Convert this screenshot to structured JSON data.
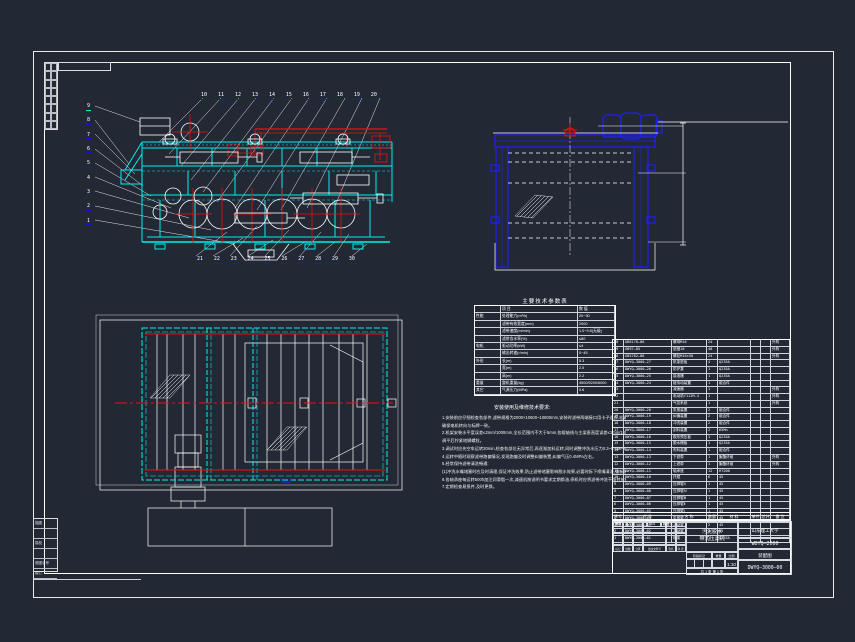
{
  "colors": {
    "background": "#222834",
    "cyan": "#00f0f0",
    "red": "#ee1111",
    "blue": "#2020ee",
    "white": "#ffffff",
    "callout_underline": "#1414e6"
  },
  "callouts": {
    "left": [
      "9",
      "8",
      "7",
      "6",
      "5",
      "4",
      "3",
      "2",
      "1"
    ],
    "top": [
      "10",
      "11",
      "12",
      "13",
      "14",
      "15",
      "16",
      "17",
      "18",
      "19",
      "20"
    ],
    "bottom": [
      "21",
      "22",
      "23",
      "24",
      "25",
      "26",
      "27",
      "28",
      "29",
      "30"
    ]
  },
  "params": {
    "title": "主要技术参数表",
    "rows": [
      {
        "g": "",
        "n": "项  目",
        "v": "数  值"
      },
      {
        "g": "性能",
        "n": "处理能力(m³/h)",
        "v": "20~30"
      },
      {
        "g": "",
        "n": "滤带有效宽度(mm)",
        "v": "2000"
      },
      {
        "g": "",
        "n": "滤带速度(m/min)",
        "v": "1.0~9.8(无级)"
      },
      {
        "g": "",
        "n": "滤饼含水率(%)",
        "v": "≤80"
      },
      {
        "g": "电机",
        "n": "驱动功率(kW)",
        "v": "≤4"
      },
      {
        "g": "",
        "n": "输出转速(r/min)",
        "v": "0~45"
      },
      {
        "g": "外形",
        "n": "长(m)",
        "v": "5.3"
      },
      {
        "g": "",
        "n": "宽(m)",
        "v": "2.5"
      },
      {
        "g": "",
        "n": "高(m)",
        "v": "2.2"
      },
      {
        "g": "重量",
        "n": "整机重量(kg)",
        "v": "4500/5200/6000"
      },
      {
        "g": "其它",
        "n": "气源压力(MPa)",
        "v": "0.6"
      }
    ]
  },
  "notes": {
    "title": "安装使用及维修技术要求:",
    "lines": [
      "1.安装前应仔细检查各部件,滤带规格为2000×10600~10800mm,安装时滤带两端接口用卡子连接,松紧适度,380V/50Hz电源接线,",
      "   确保电机转向与标牌一致。",
      "2.机架安装水平度误差≤2mm/1000mm,全长范围内不大于5mm,各辊轴线与主梁垂直度误差≤1mm/1000mm,否则影响滤带运行。",
      "   调平后拧紧地脚螺栓。",
      "3.调试时应先空车运转30min,检查各部位无异常后,再逐渐加料运转,同时调整冲洗水压力0.3~0.5MPa,保证冲洗效果良好。",
      "4.运转中随时观察滤带跑偏情况,发现跑偏及时调整纠偏装置,纠偏气压0.4MPa左右。",
      "5.经常保持滤带清洗畅通:",
      "   (1)冲洗水嘴堵塞时应及时清理,保证冲洗效果,防止滤带堵塞影响脱水效果,必要时拆下喷嘴清洗,重新装好后方可使用。",
      "6.各轴承座每运转500h加注润滑脂一次,减速机按说明书要求定期换油,停机时应将滤带冲洗干净并放松张紧装置。",
      "7.定期检查易损件,及时更换。"
    ]
  },
  "bom": {
    "headers": [
      "序号",
      "代  号",
      "名  称",
      "数量",
      "材  料",
      "单件",
      "总计",
      "备 注"
    ],
    "rows": [
      {
        "no": "30",
        "code": "GB6170—86",
        "name": "螺母M16",
        "qty": "24",
        "mat": "",
        "w1": "",
        "w2": "",
        "rem": "外购"
      },
      {
        "no": "29",
        "code": "GB97—85",
        "name": "垫圈16",
        "qty": "48",
        "mat": "",
        "w1": "",
        "w2": "",
        "rem": "外购"
      },
      {
        "no": "28",
        "code": "GB5782—86",
        "name": "螺栓M16×50",
        "qty": "24",
        "mat": "",
        "w1": "",
        "w2": "",
        "rem": "外购"
      },
      {
        "no": "27",
        "code": "DWYQ—3000—27",
        "name": "机架垫板",
        "qty": "4",
        "mat": "Q235A",
        "w1": "",
        "w2": "",
        "rem": ""
      },
      {
        "no": "26",
        "code": "DWYQ—3000—26",
        "name": "防护罩",
        "qty": "1",
        "mat": "Q235A",
        "w1": "",
        "w2": "",
        "rem": ""
      },
      {
        "no": "25",
        "code": "DWYQ—3000—25",
        "name": "接液槽",
        "qty": "1",
        "mat": "Q235A",
        "w1": "",
        "w2": "",
        "rem": ""
      },
      {
        "no": "24",
        "code": "DWYQ—3000—24",
        "name": "链传动装置",
        "qty": "1",
        "mat": "组合件",
        "w1": "",
        "w2": "",
        "rem": ""
      },
      {
        "no": "23",
        "code": "",
        "name": "减速器",
        "qty": "1",
        "mat": "",
        "w1": "",
        "w2": "",
        "rem": "外购"
      },
      {
        "no": "22",
        "code": "",
        "name": "电动机Y112M-4",
        "qty": "1",
        "mat": "",
        "w1": "",
        "w2": "",
        "rem": "外购"
      },
      {
        "no": "21",
        "code": "",
        "name": "气控系统",
        "qty": "1",
        "mat": "",
        "w1": "",
        "w2": "",
        "rem": "外购"
      },
      {
        "no": "20",
        "code": "DWYQ—3000—20",
        "name": "张紧装置",
        "qty": "2",
        "mat": "组合件",
        "w1": "",
        "w2": "",
        "rem": ""
      },
      {
        "no": "19",
        "code": "DWYQ—3000—19",
        "name": "纠偏装置",
        "qty": "2",
        "mat": "组合件",
        "w1": "",
        "w2": "",
        "rem": ""
      },
      {
        "no": "18",
        "code": "DWYQ—3000—18",
        "name": "冲洗装置",
        "qty": "2",
        "mat": "组合件",
        "w1": "",
        "w2": "",
        "rem": ""
      },
      {
        "no": "17",
        "code": "DWYQ—3000—17",
        "name": "刮料装置",
        "qty": "2",
        "mat": "65Mn",
        "w1": "",
        "w2": "",
        "rem": ""
      },
      {
        "no": "16",
        "code": "DWYQ—3000—16",
        "name": "楔形预压板",
        "qty": "1",
        "mat": "Q235A",
        "w1": "",
        "w2": "",
        "rem": ""
      },
      {
        "no": "15",
        "code": "DWYQ—3000—15",
        "name": "脱水栅板",
        "qty": "1",
        "mat": "Q235A",
        "w1": "",
        "w2": "",
        "rem": ""
      },
      {
        "no": "14",
        "code": "DWYQ—3000—14",
        "name": "布料装置",
        "qty": "1",
        "mat": "组合件",
        "w1": "",
        "w2": "",
        "rem": ""
      },
      {
        "no": "13",
        "code": "DWYQ—3000—13",
        "name": "下滤带",
        "qty": "1",
        "mat": "聚酯纤维",
        "w1": "",
        "w2": "",
        "rem": "外购"
      },
      {
        "no": "12",
        "code": "DWYQ—3000—12",
        "name": "上滤带",
        "qty": "1",
        "mat": "聚酯纤维",
        "w1": "",
        "w2": "",
        "rem": "外购"
      },
      {
        "no": "11",
        "code": "DWYQ—3000—11",
        "name": "轴承座",
        "qty": "12",
        "mat": "HT200",
        "w1": "",
        "w2": "",
        "rem": ""
      },
      {
        "no": "10",
        "code": "DWYQ—3000—10",
        "name": "托辊",
        "qty": "6",
        "mat": "45",
        "w1": "",
        "w2": "",
        "rem": ""
      },
      {
        "no": "9",
        "code": "DWYQ—3000—09",
        "name": "压榨辊Ⅴ",
        "qty": "1",
        "mat": "45",
        "w1": "",
        "w2": "",
        "rem": ""
      },
      {
        "no": "8",
        "code": "DWYQ—3000—08",
        "name": "压榨辊Ⅳ",
        "qty": "1",
        "mat": "45",
        "w1": "",
        "w2": "",
        "rem": ""
      },
      {
        "no": "7",
        "code": "DWYQ—3000—07",
        "name": "压榨辊Ⅲ",
        "qty": "1",
        "mat": "45",
        "w1": "",
        "w2": "",
        "rem": ""
      },
      {
        "no": "6",
        "code": "DWYQ—3000—06",
        "name": "压榨辊Ⅱ",
        "qty": "1",
        "mat": "45",
        "w1": "",
        "w2": "",
        "rem": ""
      },
      {
        "no": "5",
        "code": "DWYQ—3000—05",
        "name": "压榨辊Ⅰ",
        "qty": "1",
        "mat": "45",
        "w1": "",
        "w2": "",
        "rem": ""
      },
      {
        "no": "4",
        "code": "DWYQ—3000—04",
        "name": "张紧辊",
        "qty": "2",
        "mat": "45",
        "w1": "",
        "w2": "",
        "rem": ""
      },
      {
        "no": "3",
        "code": "DWYQ—3000—03",
        "name": "从动辊",
        "qty": "2",
        "mat": "45",
        "w1": "",
        "w2": "",
        "rem": ""
      },
      {
        "no": "2",
        "code": "DWYQ—3000—02",
        "name": "主动辊",
        "qty": "2",
        "mat": "45",
        "w1": "",
        "w2": "",
        "rem": ""
      },
      {
        "no": "1",
        "code": "DWYQ—3000—01",
        "name": "机架",
        "qty": "1",
        "mat": "Q235A",
        "w1": "",
        "w2": "",
        "rem": ""
      }
    ]
  },
  "title_block": {
    "sign_row": [
      "标记",
      "处数",
      "分区",
      "更改文件号",
      "签名",
      "年.月.日"
    ],
    "roles": [
      {
        "l": "设计",
        "n": "王磊",
        "d": "05.6",
        "r": "标准化"
      },
      {
        "l": "审核",
        "n": "",
        "d": "",
        "r": ""
      },
      {
        "l": "工艺",
        "n": "",
        "d": "",
        "r": "批准"
      },
      {
        "l": "",
        "n": "",
        "d": "",
        "r": ""
      }
    ],
    "product_line1": "污泥脱水",
    "product_line2": "带式压滤机",
    "stage_headers": [
      "阶段标记",
      "重量",
      "比例"
    ],
    "scale": "1:10",
    "sheet": "共 1 张  第 1 张",
    "org": "山东理工大学",
    "model": "WDYQ—2000",
    "doc_type": "装配图",
    "drawing_no": "DWYQ—3000—00"
  },
  "margin": {
    "rows": [
      "描图",
      "",
      "描校",
      "",
      "底图总号",
      "装订"
    ]
  }
}
